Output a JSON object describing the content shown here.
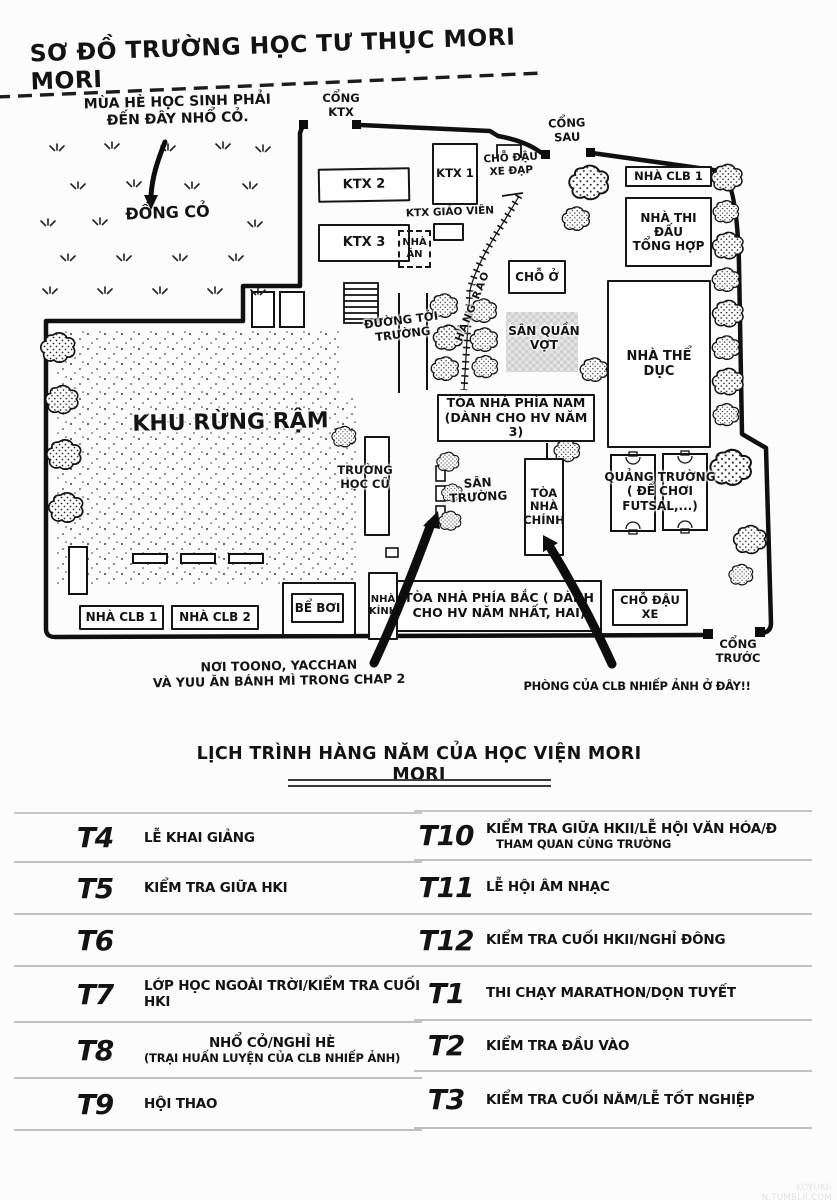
{
  "map": {
    "title": "SƠ ĐỒ TRƯỜNG HỌC TƯ THỤC MORI MORI",
    "grass_note": "MÙA HÈ HỌC SINH PHẢI\nĐẾN ĐÂY NHỔ CỎ.",
    "dong_co": "ĐỒNG CỎ",
    "gates": {
      "ktx": "CỔNG\nKTX",
      "sau": "CỔNG\nSAU",
      "truoc": "CỔNG\nTRƯỚC"
    },
    "b": {
      "ktx2": "KTX 2",
      "ktx3": "KTX 3",
      "ktx1": "KTX 1",
      "ktx_gv": "KTX GIÁO VIÊN",
      "nha_an": "NHÀ\nĂN",
      "bike": "CHỖ ĐẬU\nXE ĐẠP",
      "cho_o": "CHỖ Ở",
      "tennis": "SÂN QUẦN\nVỢT",
      "clb1_top": "NHÀ CLB 1",
      "thi_dau": "NHÀ THI ĐẤU\nTỔNG HỢP",
      "the_duc": "NHÀ THỂ DỤC",
      "toa_nam": "TÒA NHÀ PHÍA NAM\n(DÀNH CHO HV NĂM 3)",
      "truong_cu": "TRƯỜNG\nHỌC CŨ",
      "san_truong": "SÂN\nTRƯỜNG",
      "toa_chinh": "TÒA\nNHÀ\nCHÍNH",
      "quang_truong": "QUẢNG TRƯỜNG\n( ĐỂ CHƠI FUTSAL,...)",
      "toa_bac": "TÒA NHÀ PHÍA BẮC ( DÀNH\nCHO HV NĂM NHẤT, HAI)",
      "parking": "CHỖ ĐẬU XE",
      "be_boi": "BỂ BƠI",
      "nha_kinh": "NHÀ\nKÍNH",
      "clb1": "NHÀ CLB 1",
      "clb2": "NHÀ CLB 2",
      "forest": "KHU RỪNG RẬM",
      "road": "ĐƯỜNG TỚI\nTRƯỜNG",
      "fence": "HÀNG RÀO"
    },
    "annot_bread": "NƠI TOONO, YACCHAN\nVÀ YUU ĂN BÁNH MÌ TRONG CHAP 2",
    "annot_photo": "PHÒNG CỦA CLB NHIẾP ẢNH Ở ĐÂY!!"
  },
  "schedule": {
    "title": "LỊCH TRÌNH HÀNG NĂM CỦA HỌC VIỆN MORI MORI",
    "left": [
      {
        "month": "T4",
        "desc": "LỄ KHAI GIẢNG"
      },
      {
        "month": "T5",
        "desc": "KIỂM TRA GIỮA HKI"
      },
      {
        "month": "T6",
        "desc": ""
      },
      {
        "month": "T7",
        "desc": "LỚP HỌC NGOÀI TRỜI/KIỂM TRA CUỐI HKI"
      },
      {
        "month": "T8",
        "desc": "NHỔ CỎ/NGHỈ HÈ",
        "sub": "(TRẠI HUẤN LUYỆN CỦA CLB NHIẾP ẢNH)"
      },
      {
        "month": "T9",
        "desc": "HỘI THAO"
      }
    ],
    "right": [
      {
        "month": "T10",
        "desc": "KIỂM TRA GIỮA HKII/LỄ HỘI VĂN HÓA/Đ",
        "sub": "THAM QUAN CÙNG TRƯỜNG"
      },
      {
        "month": "T11",
        "desc": "LỄ HỘI ÂM NHẠC"
      },
      {
        "month": "T12",
        "desc": "KIỂM TRA CUỐI HKII/NGHỈ ĐÔNG"
      },
      {
        "month": "T1",
        "desc": "THI CHẠY MARATHON/DỌN TUYẾT"
      },
      {
        "month": "T2",
        "desc": "KIỂM TRA ĐẦU VÀO"
      },
      {
        "month": "T3",
        "desc": "KIỂM TRA CUỐI NĂM/LỄ TỐT NGHIỆP"
      }
    ]
  },
  "watermark": "KOYUKI-N.TUMBLR.COM"
}
